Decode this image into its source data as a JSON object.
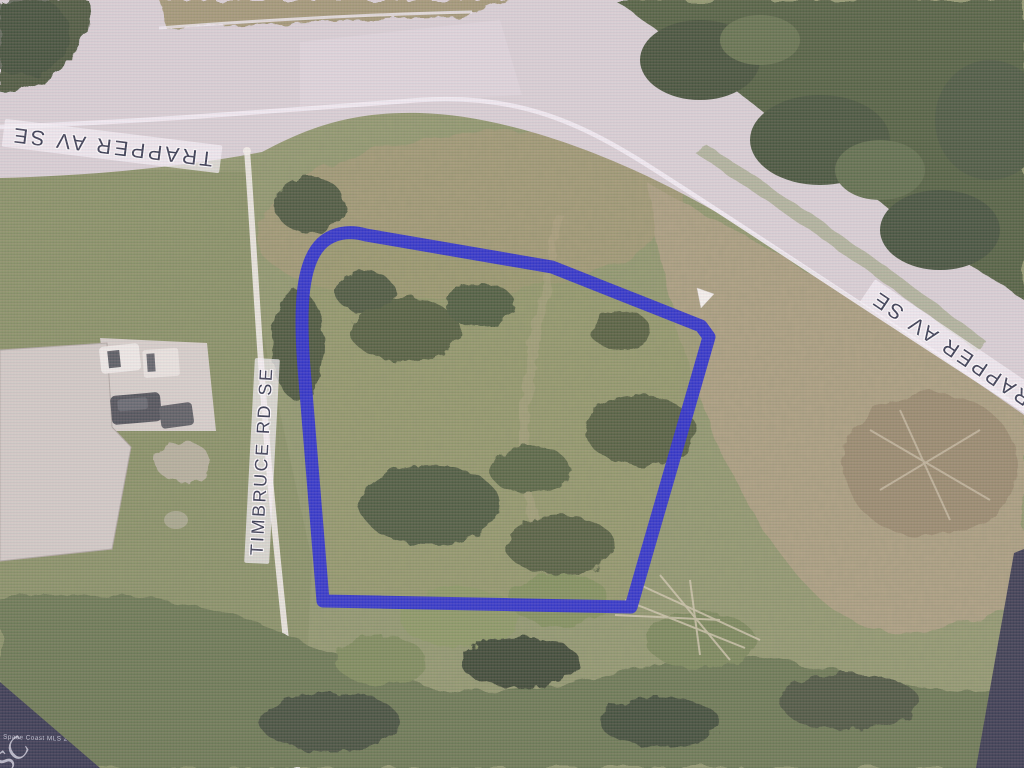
{
  "map": {
    "type": "aerial-parcel-photo",
    "street_labels": [
      {
        "id": "trapper-av-top",
        "text": "TRAPPER AV SE"
      },
      {
        "id": "trapper-av-right",
        "text": "TRAPPER AV SE"
      },
      {
        "id": "timbruce-rd",
        "text": "TIMBRUCE RD SE"
      }
    ],
    "parcel_boundary": {
      "color": "#1b20d4",
      "stroke_width": 13,
      "path": "M323,601 L305,380 C298,302 303,261 322,243 C333,233 349,230 366,235 L552,267 L701,326 L709,337 L631,607 Z"
    },
    "marker": {
      "shape": "white-triangle",
      "color": "#f3f1ec"
    },
    "watermark": {
      "small_text": "Space Coast MLS 2021",
      "big_text": "SC"
    },
    "colors": {
      "road": "#d5cdd2",
      "label_text": "#262c44",
      "watermark_band": "#242842",
      "grass": "#87925e",
      "trees": "#42542f",
      "dry_grass": "#a79b74"
    }
  }
}
